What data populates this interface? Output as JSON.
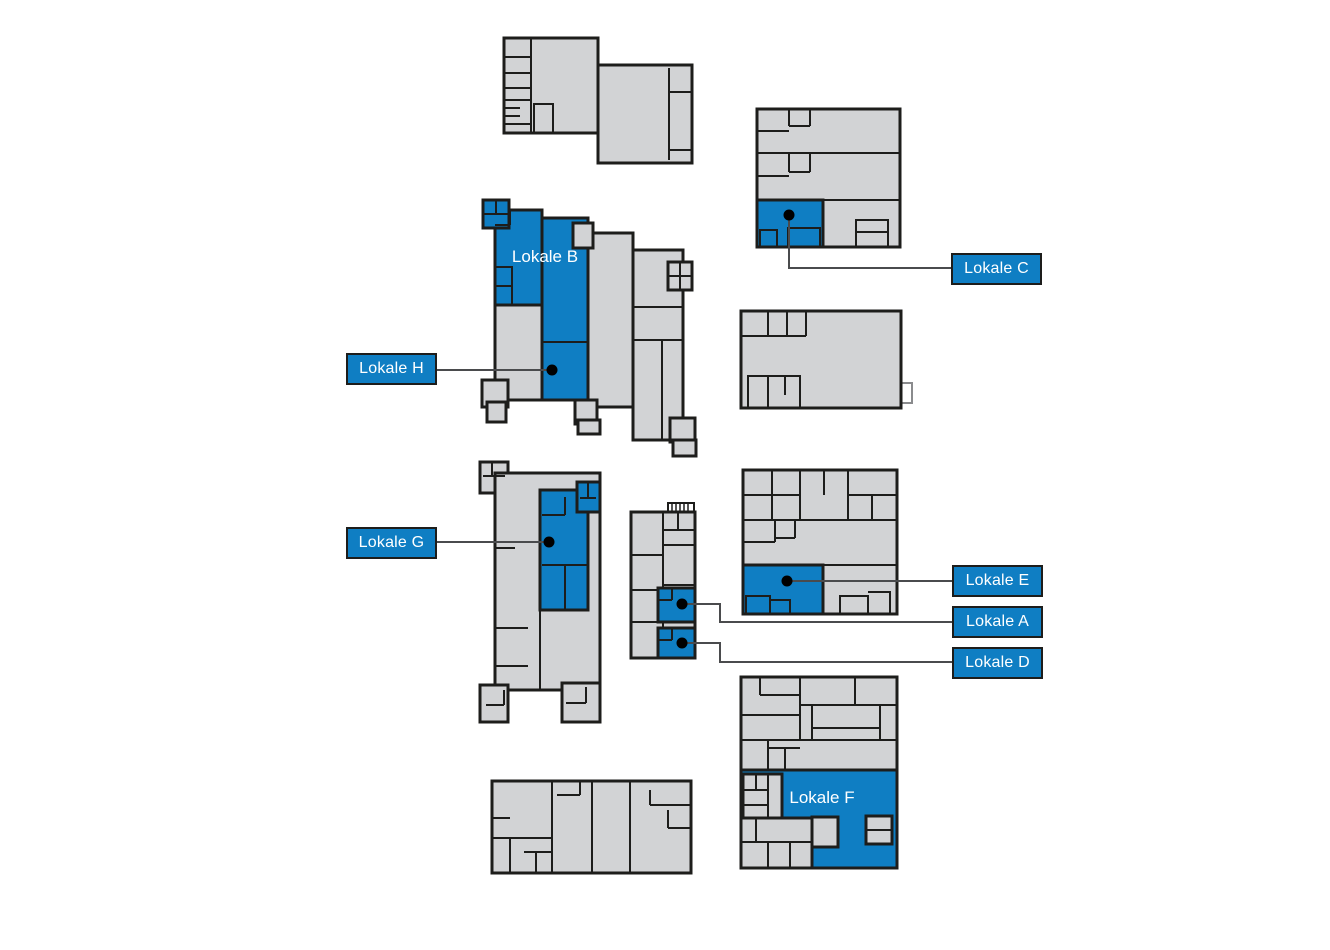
{
  "palette": {
    "canvas-bg": "#ffffff",
    "building-fill": "#d2d3d5",
    "building-outline": "#1d1d1b",
    "highlight-blue": "#0f7ec3",
    "leader-line": "#4a4b4d",
    "marker-dot": "#000000",
    "label-text": "#ffffff"
  },
  "labels": {
    "a": {
      "text": "Lokale A"
    },
    "b": {
      "text": "Lokale B"
    },
    "c": {
      "text": "Lokale C"
    },
    "d": {
      "text": "Lokale D"
    },
    "e": {
      "text": "Lokale E"
    },
    "f": {
      "text": "Lokale F"
    },
    "g": {
      "text": "Lokale G"
    },
    "h": {
      "text": "Lokale H"
    }
  }
}
